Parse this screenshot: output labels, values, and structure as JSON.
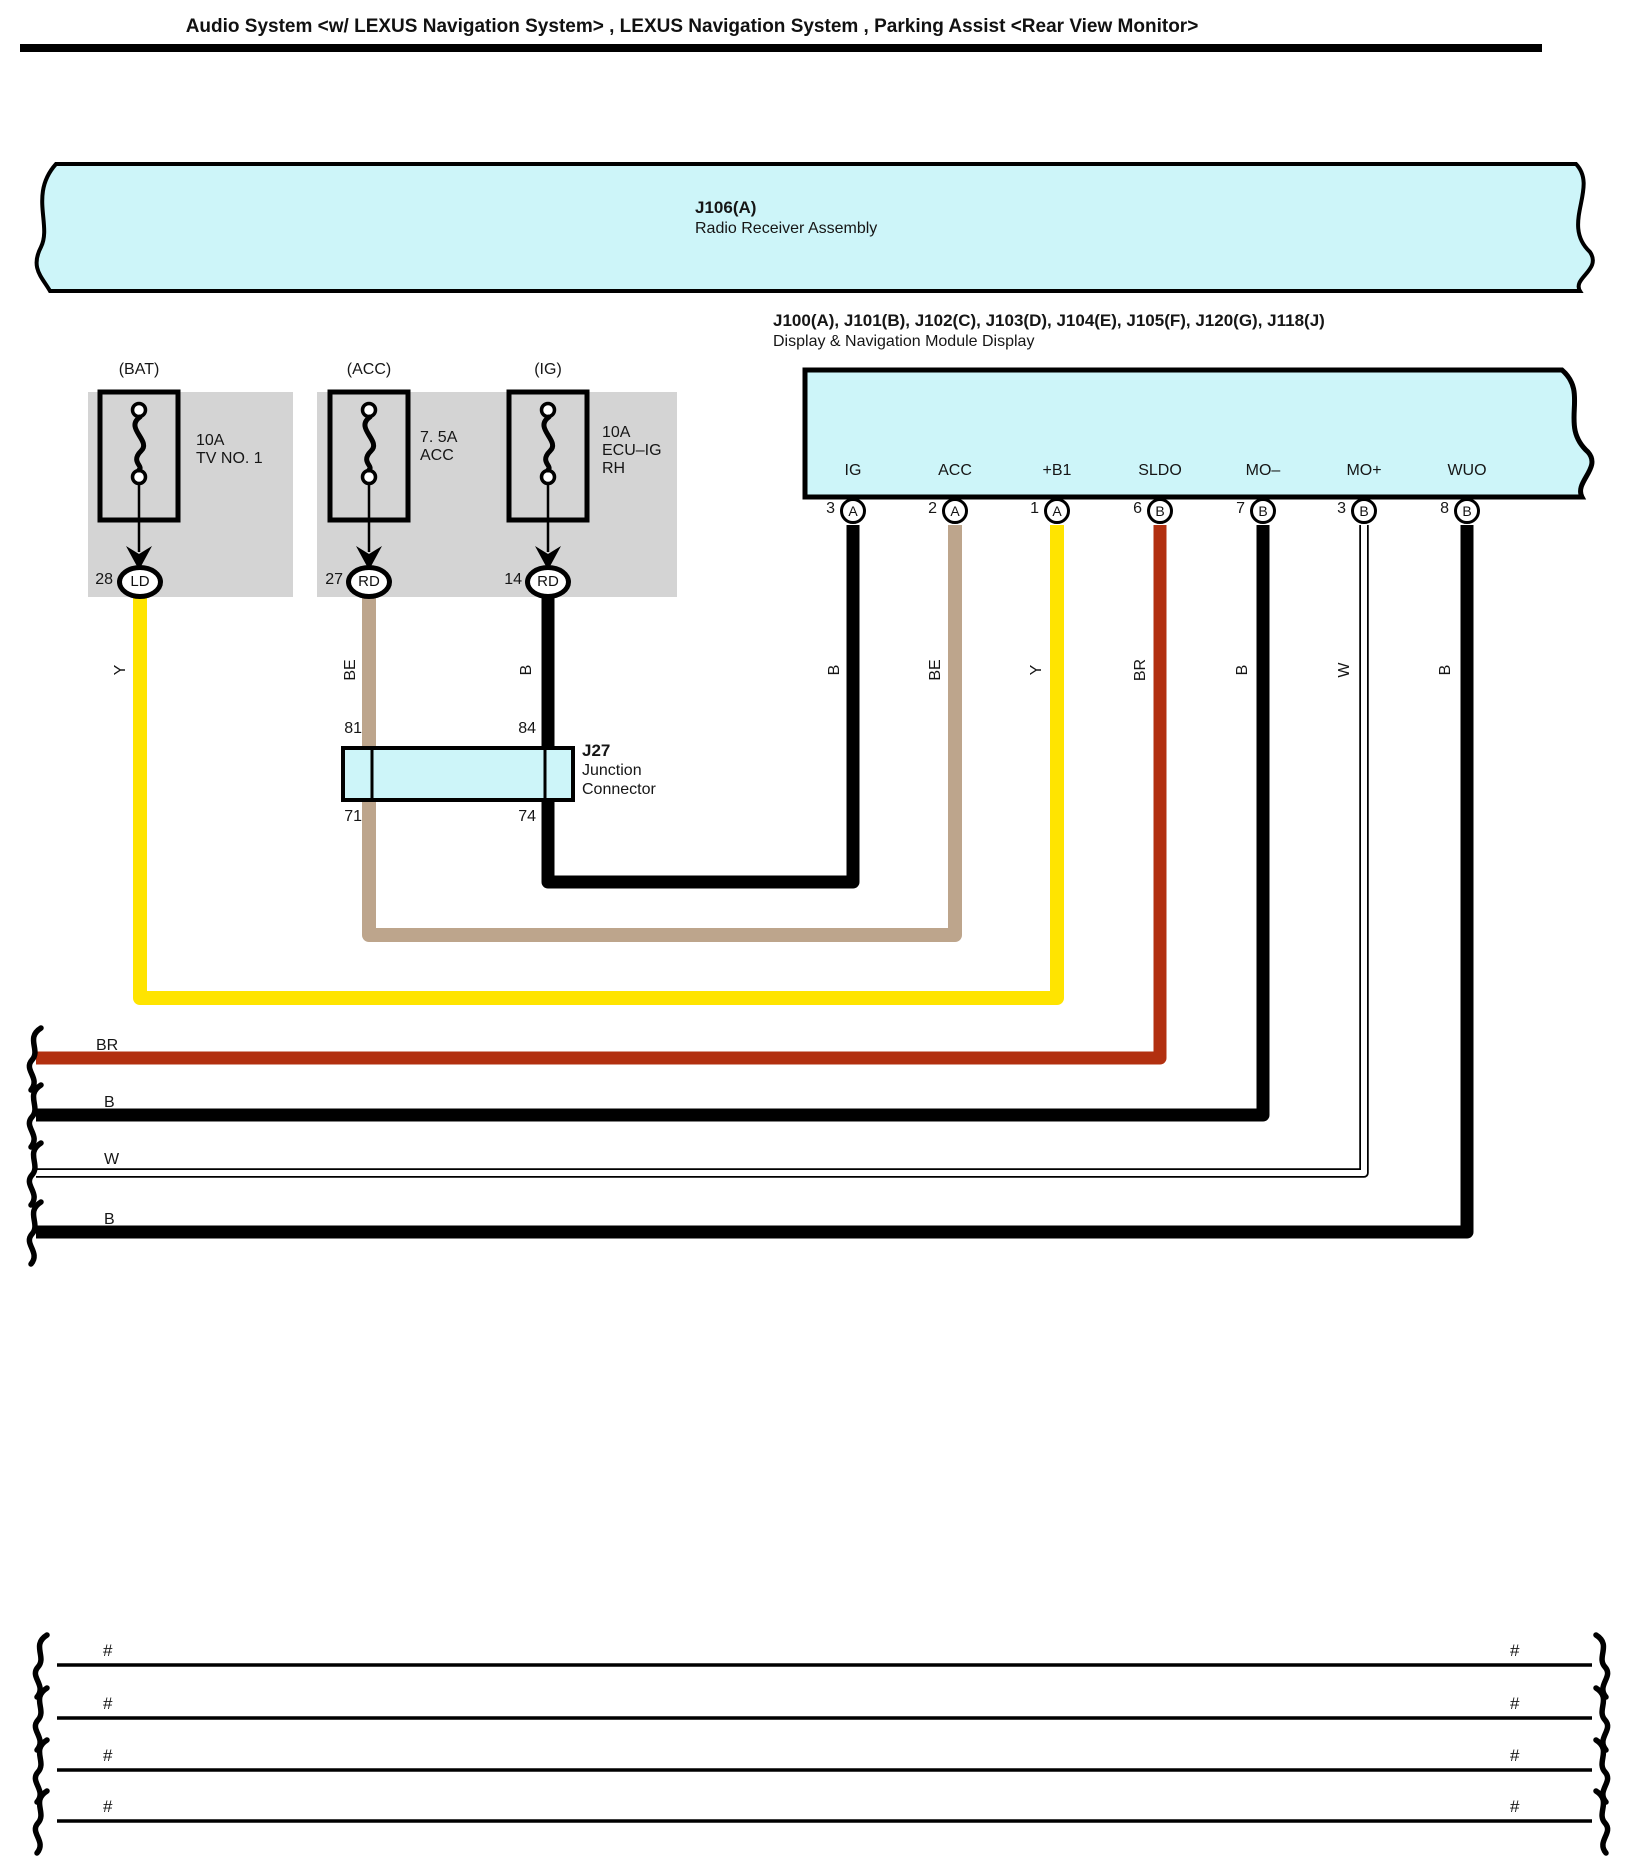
{
  "page": {
    "title": "Audio System <w/ LEXUS Navigation System> , LEXUS Navigation System , Parking Assist <Rear View Monitor>"
  },
  "colors": {
    "cyan_fill": "#cdf5f9",
    "gray_fill": "#d4d4d4",
    "wire_yellow": "#ffe400",
    "wire_beige": "#bda58c",
    "wire_brown": "#b23010",
    "wire_black": "#000000",
    "wire_white": "#ffffff"
  },
  "banner": {
    "code": "J106(A)",
    "name": "Radio Receiver Assembly"
  },
  "display_module": {
    "codes": "J100(A), J101(B), J102(C), J103(D), J104(E), J105(F), J120(G), J118(J)",
    "name": "Display & Navigation Module Display",
    "pins": [
      {
        "name": "IG",
        "number": "3",
        "connector": "A"
      },
      {
        "name": "ACC",
        "number": "2",
        "connector": "A"
      },
      {
        "name": "+B1",
        "number": "1",
        "connector": "A"
      },
      {
        "name": "SLDO",
        "number": "6",
        "connector": "B"
      },
      {
        "name": "MO–",
        "number": "7",
        "connector": "B"
      },
      {
        "name": "MO+",
        "number": "3",
        "connector": "B"
      },
      {
        "name": "WUO",
        "number": "8",
        "connector": "B"
      }
    ]
  },
  "fuses": [
    {
      "source": "(BAT)",
      "rating": "10A",
      "name_line1": "TV NO. 1",
      "name_line2": "",
      "pin": "28",
      "terminal": "LD"
    },
    {
      "source": "(ACC)",
      "rating": "7. 5A",
      "name_line1": "ACC",
      "name_line2": "",
      "pin": "27",
      "terminal": "RD"
    },
    {
      "source": "(IG)",
      "rating": "10A",
      "name_line1": "ECU–IG",
      "name_line2": "RH",
      "pin": "14",
      "terminal": "RD"
    }
  ],
  "junction": {
    "code": "J27",
    "type_line1": "Junction",
    "type_line2": "Connector",
    "top_left_pin": "81",
    "top_right_pin": "84",
    "bottom_left_pin": "71",
    "bottom_right_pin": "74"
  },
  "vertical_labels": [
    "Y",
    "BE",
    "B",
    "B",
    "BE",
    "Y",
    "BR",
    "B",
    "W",
    "B"
  ],
  "offpage_wires": [
    {
      "label": "BR"
    },
    {
      "label": "B"
    },
    {
      "label": "W"
    },
    {
      "label": "B"
    }
  ],
  "bottom_rows": [
    {
      "left_mark": "#",
      "right_mark": "#"
    },
    {
      "left_mark": "#",
      "right_mark": "#"
    },
    {
      "left_mark": "#",
      "right_mark": "#"
    },
    {
      "left_mark": "#",
      "right_mark": "#"
    }
  ]
}
